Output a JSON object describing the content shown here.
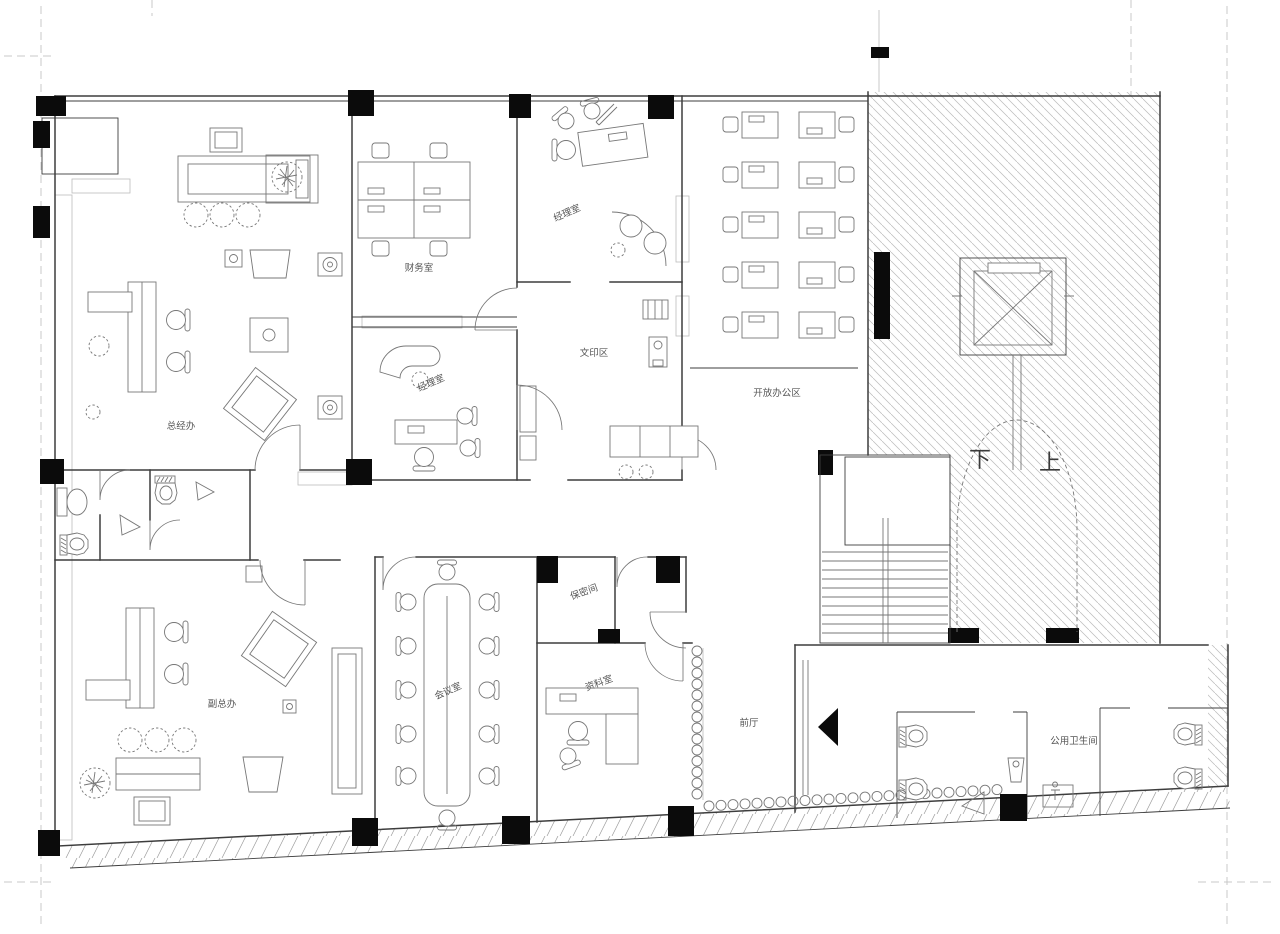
{
  "drawing": {
    "kind": "office-floor-plan",
    "palette": {
      "line": "#3d3d3d",
      "furniture": "#777777",
      "hatch": "#bcbcbc",
      "hatchstrong": "#9c9c9c",
      "column": "#0b0b0b",
      "label": "#565656",
      "ref": "#c9c9c9",
      "bg": "#ffffff"
    }
  },
  "rooms": {
    "gm_office": {
      "label": "总经办"
    },
    "finance": {
      "label": "财务室"
    },
    "manager_top": {
      "label": "经理室"
    },
    "manager_mid": {
      "label": "经理室"
    },
    "copy_area": {
      "label": "文印区"
    },
    "open_office": {
      "label": "开放办公区"
    },
    "deputy_gm_office": {
      "label": "副总办"
    },
    "meeting_room": {
      "label": "会议室"
    },
    "secure_room": {
      "label": "保密间"
    },
    "archive_room": {
      "label": "资料室"
    },
    "front_hall": {
      "label": "前厅"
    },
    "public_restroom": {
      "label": "公用卫生间"
    }
  },
  "stair": {
    "down": "下",
    "up": "上"
  }
}
